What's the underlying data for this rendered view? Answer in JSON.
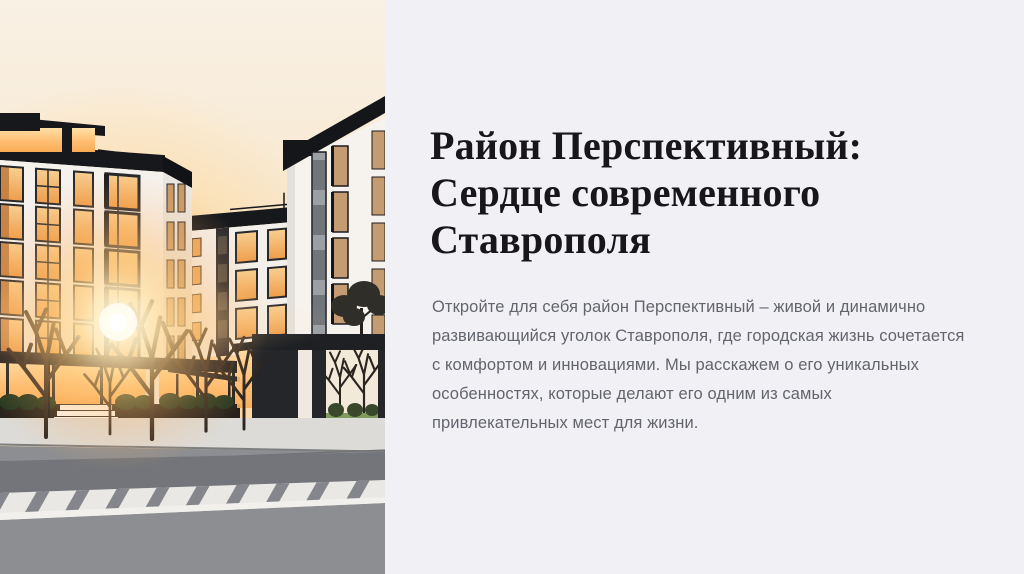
{
  "slide": {
    "panel_background": "#f1f0f5"
  },
  "hero": {
    "title_lines": [
      "Район Перспективный:",
      "Сердце современного",
      "Ставрополя"
    ],
    "title_color": "#18161b",
    "description_lines": [
      "Откройте для себя район Перспективный – живой и динамично",
      "развивающийся уголок Ставрополя, где городская жизнь сочетается",
      "с комфортом и инновациями. Мы расскажем о его уникальных",
      "особенностях, которые делают его одним из самых",
      "привлекательных мест для жизни."
    ],
    "description_color": "#63656d"
  },
  "illustration": {
    "name": "residential-district-sunset-illustration",
    "colors": {
      "sky_top": "#f9f1e5",
      "sky_horizon": "#f8dcb2",
      "sun_core": "#fffdf1",
      "sun_glow": "#ffc878",
      "building_white": "#f5f2ee",
      "roof_dark": "#17181c",
      "window_glow": "#f0a551",
      "window_tan": "#c59c72",
      "gate_dark": "#24262a",
      "bush_green": "#223620",
      "sidewalk": "#dcdbd7",
      "road": "#8c8e91",
      "crosswalk": "#eae8e4"
    }
  }
}
